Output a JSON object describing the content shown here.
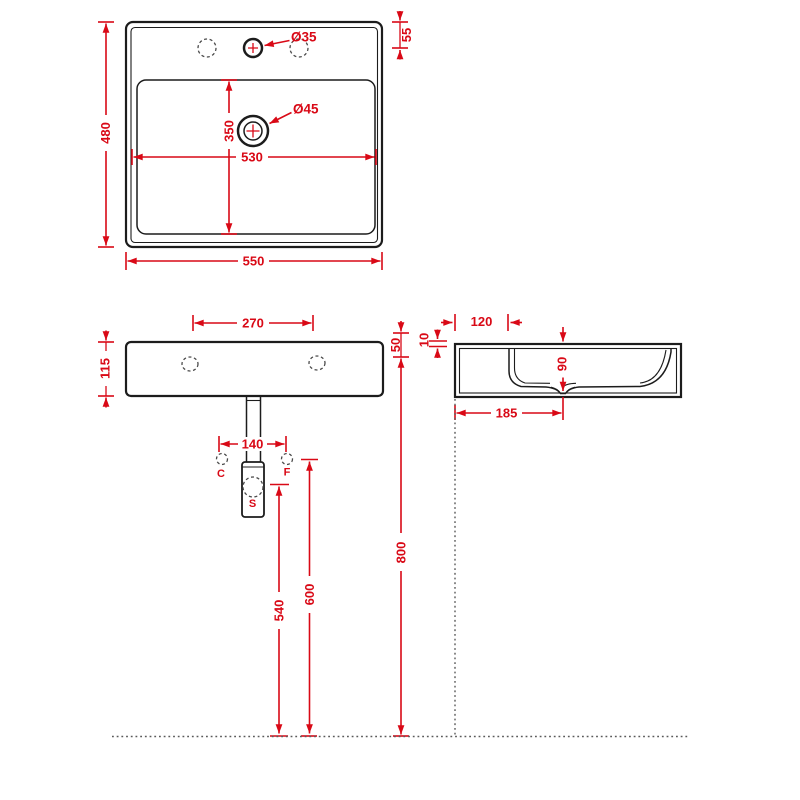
{
  "colors": {
    "dimension_accent": "#d90916",
    "outline_black": "#1c1c1c",
    "hidden_line_gray": "#4a4a4a",
    "reference_dotted_gray": "#5a5a5a",
    "background": "#ffffff"
  },
  "views": {
    "top_view": {
      "overall_depth": "480",
      "overall_width": "550",
      "tap_hole_setback": "55",
      "tap_hole_diameter": "Ø35",
      "drain_diameter": "Ø45",
      "basin_inner_depth": "350",
      "basin_inner_width": "530"
    },
    "front_view": {
      "tap_hole_spacing": "270",
      "body_height": "115",
      "wall_hole_spacing": "140",
      "hole_label_left": "C",
      "hole_label_right": "F",
      "trap_label": "S",
      "trap_height_from_floor": "540",
      "wall_holes_height_from_floor": "600"
    },
    "side_view": {
      "deck_depth": "120",
      "rim_thickness": "10",
      "front_drop": "50",
      "inner_depth": "90",
      "drain_setback": "185",
      "rim_height_from_floor": "800"
    }
  }
}
